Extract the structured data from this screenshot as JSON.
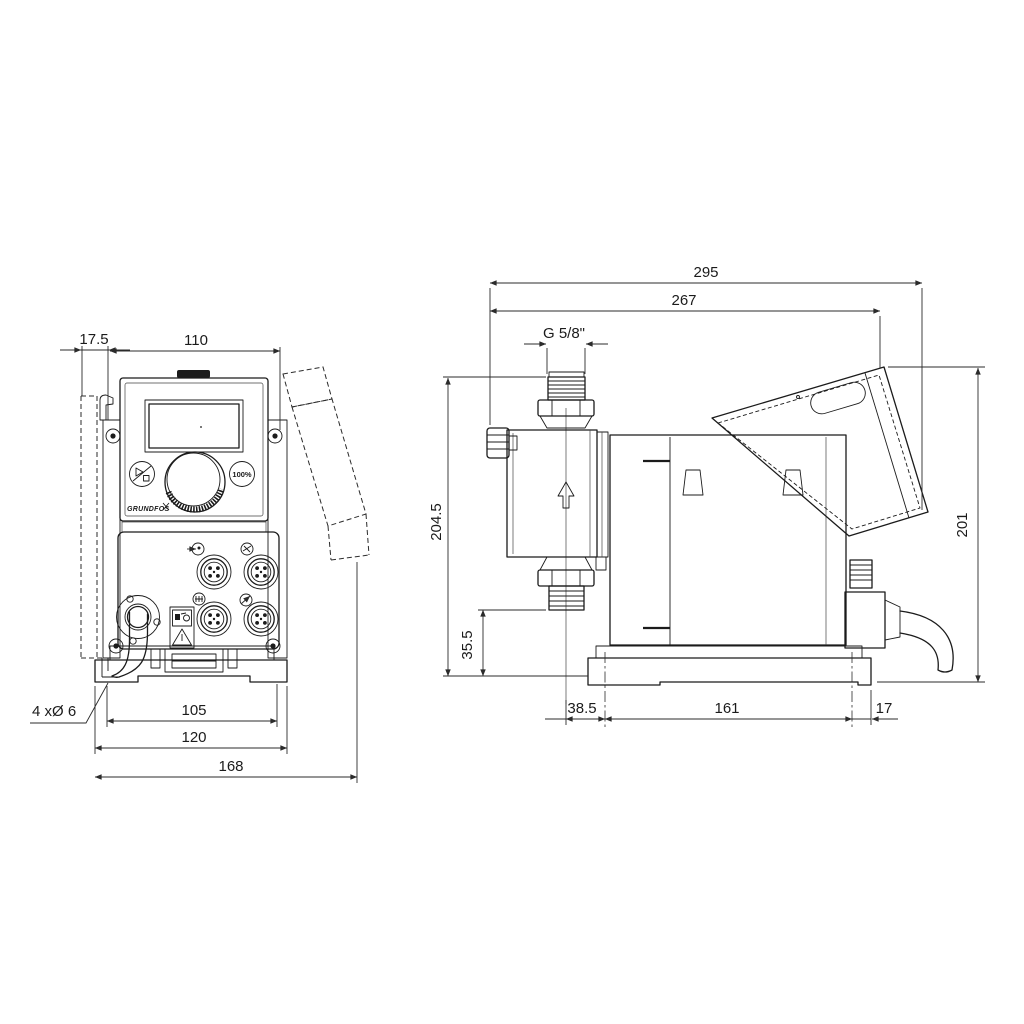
{
  "colors": {
    "ink": "#1b1b1b",
    "dim": "#2b2b2b",
    "background": "#ffffff"
  },
  "front_view": {
    "dim_offset_left": "17.5",
    "dim_width_top": "110",
    "label_mount_holes": "4 xØ 6",
    "dim_hole_pitch": "105",
    "dim_bracket_width": "120",
    "dim_overall_width": "168",
    "button_100_label": "100%",
    "logo_text": "GRUNDFOS"
  },
  "side_view": {
    "dim_overall_depth": "295",
    "dim_depth_to_cover": "267",
    "label_thread": "G 5/8\"",
    "dim_total_height": "204.5",
    "dim_outlet_height": "35.5",
    "dim_rear_height": "201",
    "dim_outlet_to_hole": "38.5",
    "dim_hole_pitch": "161",
    "dim_hole_to_rear": "17"
  }
}
